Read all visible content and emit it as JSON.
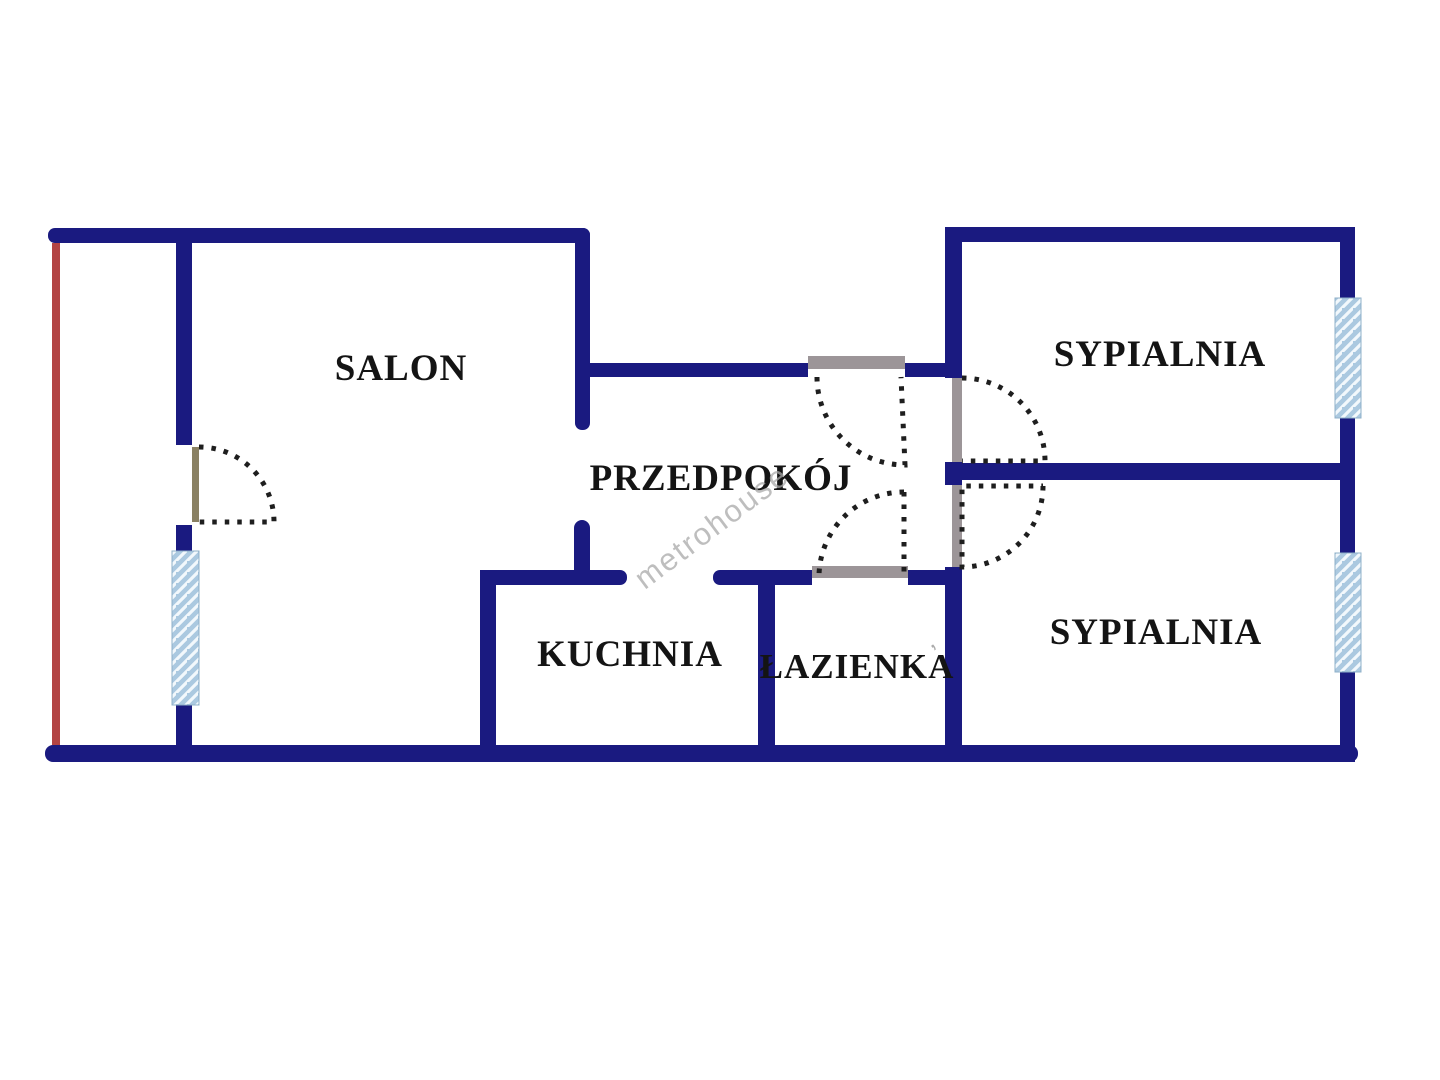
{
  "plan": {
    "rooms": {
      "salon": {
        "label": "SALON"
      },
      "przedpokoj": {
        "label": "PRZEDPOKÓJ"
      },
      "kuchnia": {
        "label": "KUCHNIA"
      },
      "lazienka": {
        "label": "ŁAZIENKA"
      },
      "sypialnia_top": {
        "label": "SYPIALNIA"
      },
      "sypialnia_bottom": {
        "label": "SYPIALNIA"
      }
    },
    "watermark": {
      "text": "metrohouse",
      "fragment": "’"
    },
    "colors": {
      "background": "#ffffff",
      "wall": "#1a1a80",
      "balcony_edge": "#b34444",
      "window_fill": "#abc9e0",
      "window_stripe": "#f2f8fc",
      "door_swing": "#1e1e1e",
      "door_jamb": "#9c9598",
      "balcony_door_leaf": "#8a8163",
      "label_text": "#141414",
      "watermark_text": "#a9a9a9"
    },
    "features": {
      "windows": [
        "balcony-window",
        "bedroom-top-window",
        "bedroom-bottom-window"
      ],
      "doors": [
        "balcony-door",
        "entrance-door",
        "bedroom-top-door",
        "bedroom-bottom-door",
        "bathroom-door",
        "kitchen-opening",
        "salon-passage"
      ]
    }
  }
}
